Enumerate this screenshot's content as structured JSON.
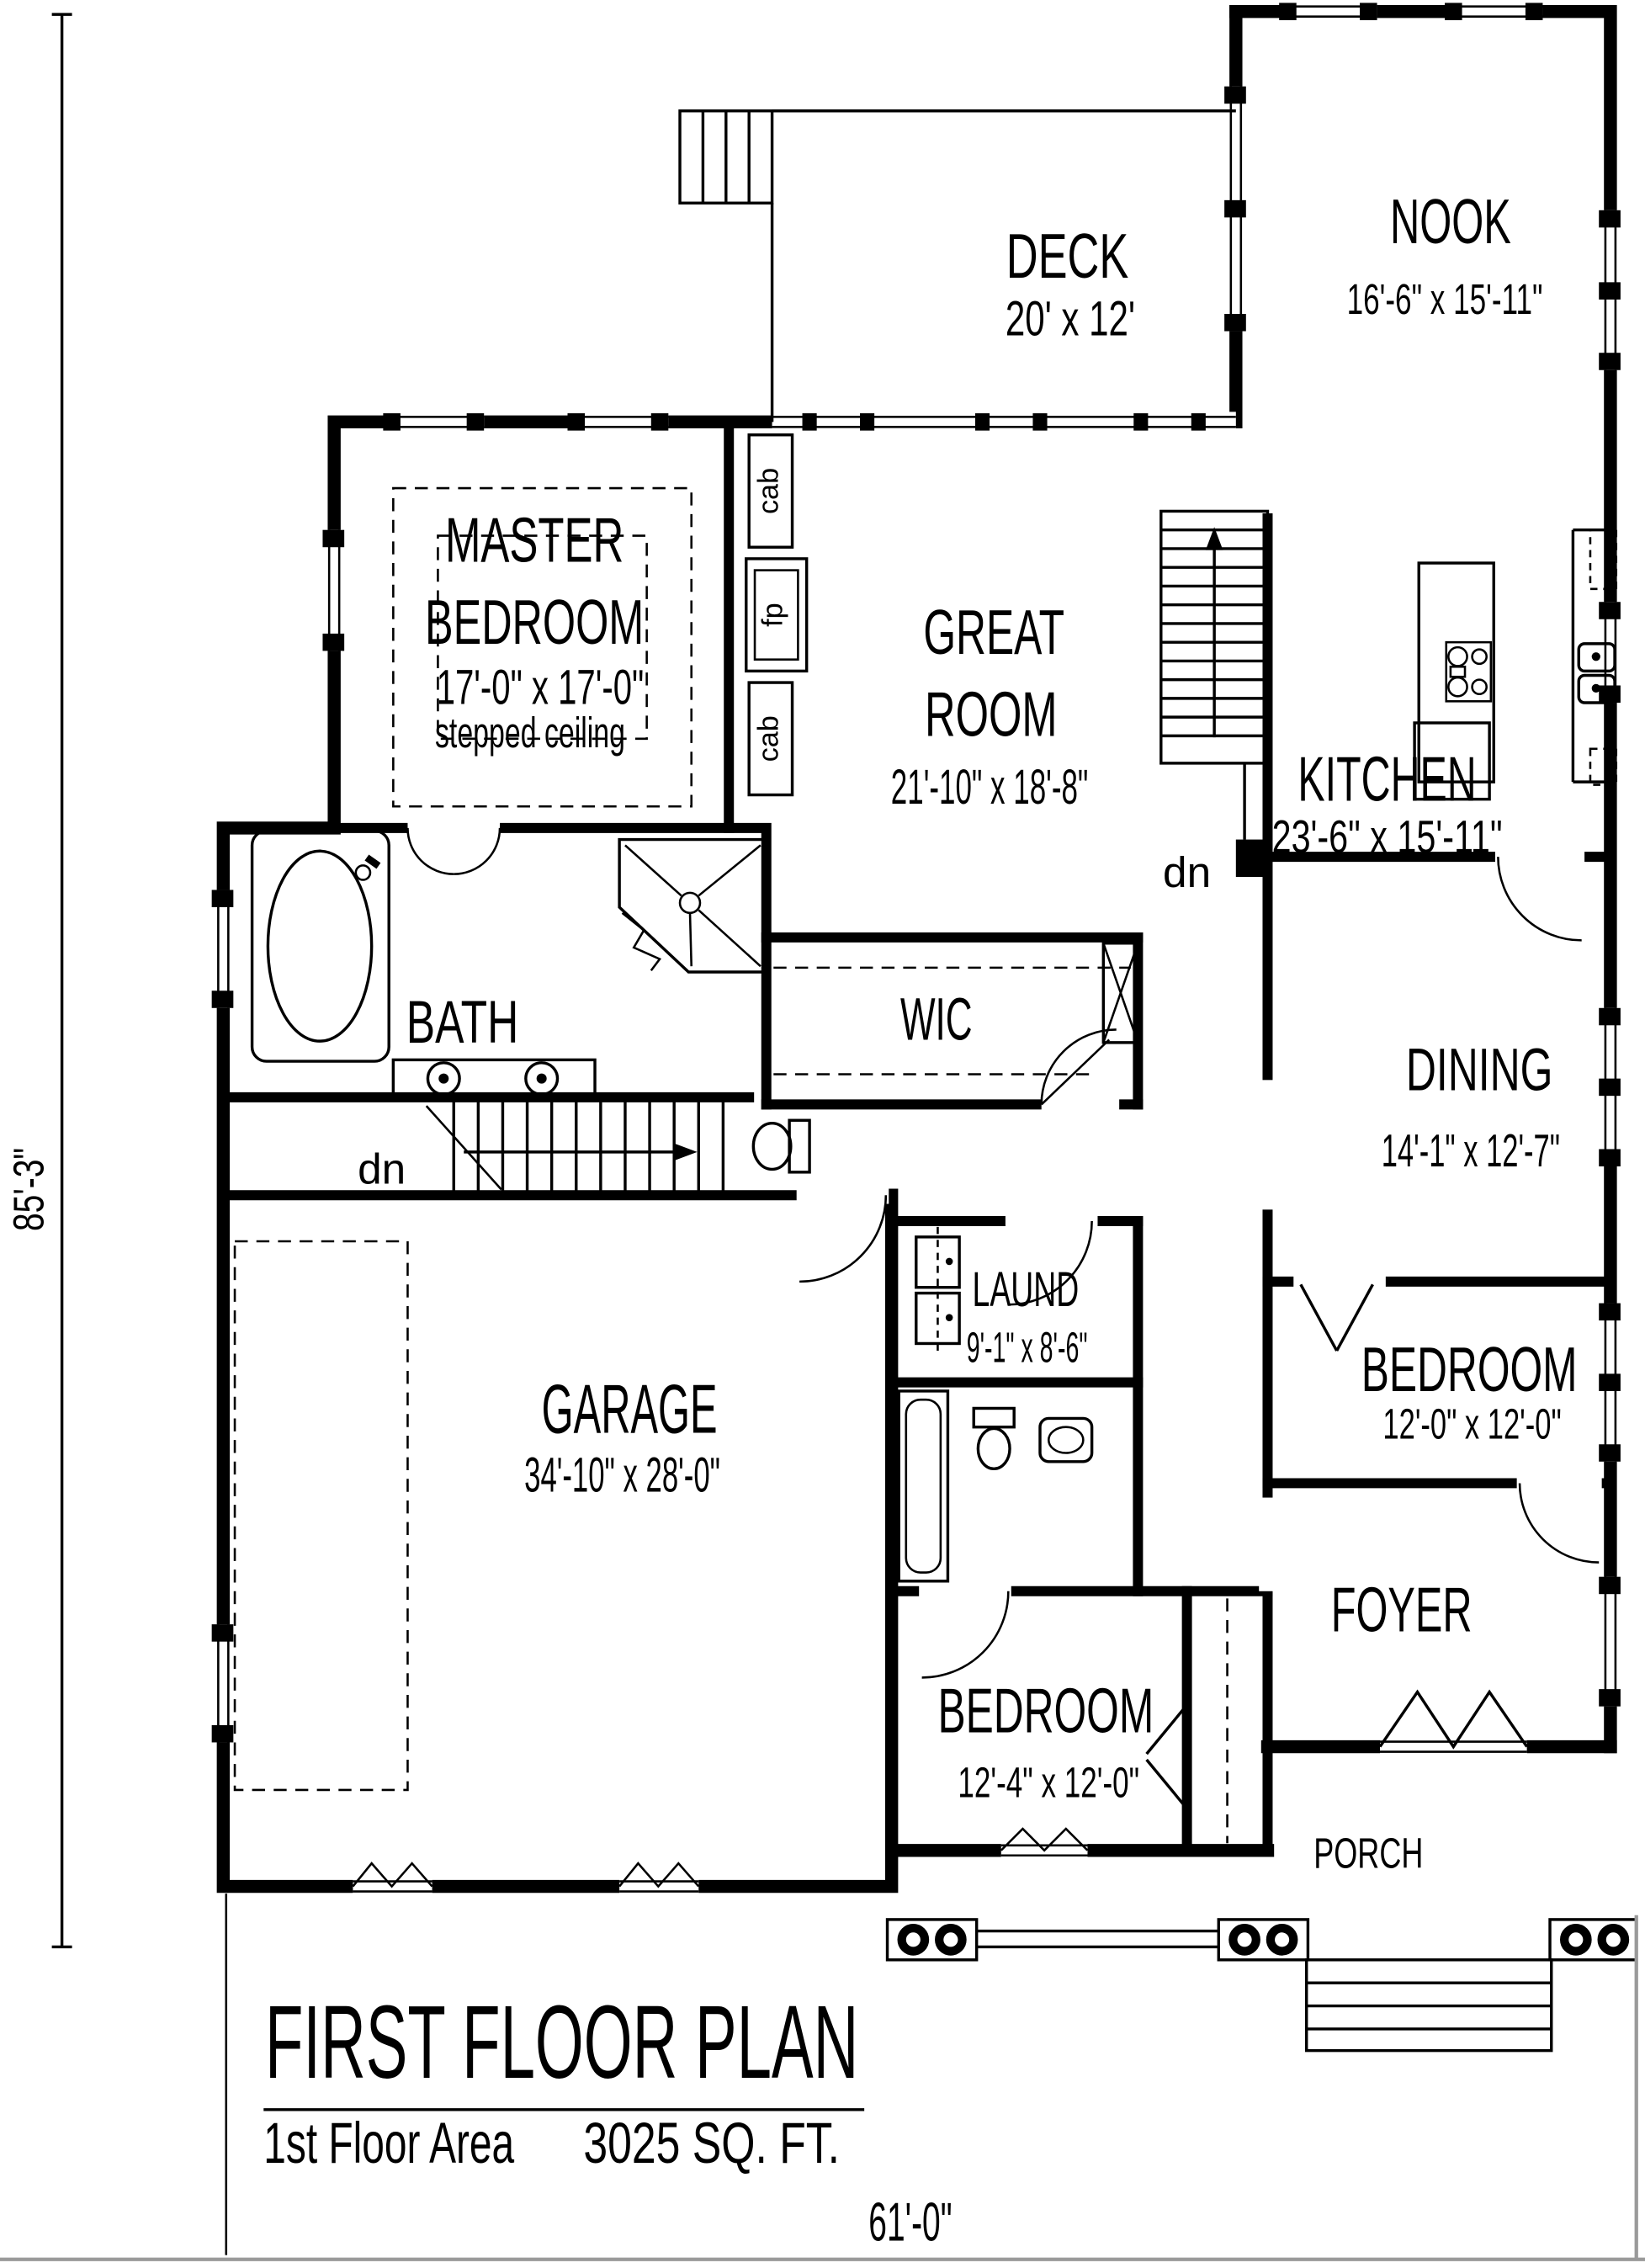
{
  "plan": {
    "title": "FIRST FLOOR PLAN",
    "area_label": "1st Floor Area",
    "area_value": "3025 SQ. FT.",
    "width_dim": "61'-0\"",
    "height_dim": "85'-3\"",
    "rooms": {
      "deck": {
        "name": "DECK",
        "dims": "20' x 12'"
      },
      "nook": {
        "name": "NOOK",
        "dims": "16'-6\" x 15'-11\""
      },
      "master_bedroom": {
        "line1": "MASTER",
        "line2": "BEDROOM",
        "dims": "17'-0\" x 17'-0\"",
        "note": "stepped ceiling"
      },
      "great_room": {
        "line1": "GREAT",
        "line2": "ROOM",
        "dims": "21'-10\" x 18'-8\""
      },
      "kitchen": {
        "name": "KITCHEN",
        "dims": "23'-6\" x 15'-11\""
      },
      "dining": {
        "name": "DINING",
        "dims": "14'-1\" x 12'-7\""
      },
      "bath": {
        "name": "BATH"
      },
      "wic": {
        "name": "WIC"
      },
      "laundry": {
        "name": "LAUND",
        "dims": "9'-1\" x 8'-6\""
      },
      "garage": {
        "name": "GARAGE",
        "dims": "34'-10\" x 28'-0\""
      },
      "bedroom_right": {
        "name": "BEDROOM",
        "dims": "12'-0\" x 12'-0\""
      },
      "bedroom_front": {
        "name": "BEDROOM",
        "dims": "12'-4\" x 12'-0\""
      },
      "foyer": {
        "name": "FOYER"
      },
      "porch": {
        "name": "PORCH"
      }
    },
    "labels": {
      "stairs_down_basement": "dn",
      "stairs_down_great": "dn",
      "cabinet_top": "cab",
      "fireplace": "fp",
      "cabinet_bottom": "cab"
    }
  }
}
